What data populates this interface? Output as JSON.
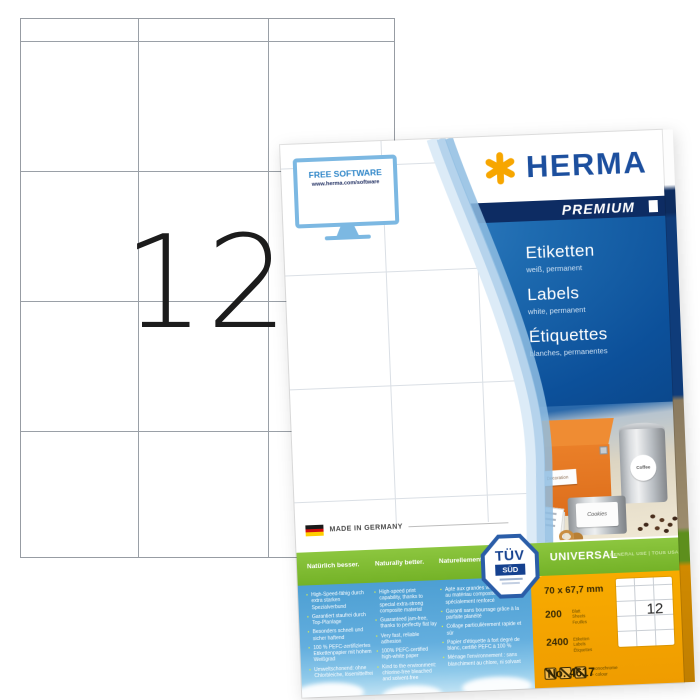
{
  "sheet": {
    "labels_per_sheet": "12"
  },
  "package": {
    "free_software": {
      "title": "FREE SOFTWARE",
      "url": "www.herma.com/software"
    },
    "brand": {
      "name": "HERMA",
      "tier": "PREMIUM",
      "brand_blue": "#1c4f9e",
      "star_yellow": "#f7a600"
    },
    "product": {
      "de": {
        "title": "Etiketten",
        "subtitle": "weiß, permanent"
      },
      "en": {
        "title": "Labels",
        "subtitle": "white, permanent"
      },
      "fr": {
        "title": "Étiquettes",
        "subtitle": "blanches, permanentes"
      }
    },
    "photo_labels": {
      "box": "Decoration",
      "coffee": "Coffee",
      "cookies": "Cookies"
    },
    "made_in": "MADE IN GERMANY",
    "claims": {
      "de": {
        "heading": "Natürlich besser.",
        "bullets": [
          "High-Speed-fähig durch extra starken Spezialverbund",
          "Garantiert staufrei durch Top-Planlage",
          "Besonders schnell und sicher haftend",
          "100 % PEFC-zertifiziertes Etikettenpapier mit hohem Weißgrad",
          "Umweltschonend: ohne Chlorbleiche, lösemittelfrei"
        ]
      },
      "en": {
        "heading": "Naturally better.",
        "bullets": [
          "High-speed print capability, thanks to special extra-strong composite material",
          "Guaranteed jam-free, thanks to perfectly flat lay",
          "Very fast, reliable adhesion",
          "100% PEFC-certified high-white paper",
          "Kind to the environment: chlorine-free bleached and solvent-free"
        ]
      },
      "fr": {
        "heading": "Naturellement mieux.",
        "bullets": [
          "Apte aux grandes vitesses grâce au matériau composite spécialement renforcé",
          "Garanti sans bourrage grâce à la parfaite planéité",
          "Collage particulièrement rapide et sûr",
          "Papier d'étiquette à fort degré de blanc, certifié PEFC à 100 %",
          "Ménage l'environnement : sans blanchiment au chlore, ni solvant"
        ]
      }
    },
    "tuv": {
      "line1": "TÜV",
      "line2": "SÜD"
    },
    "universal": {
      "title": "UNIVERSAL",
      "subtitle": "GENERAL USE | TOUS USAGES",
      "green": "#76b82a"
    },
    "specs": {
      "size": "70 x 67,7 mm",
      "sheets": {
        "value": "200",
        "units": [
          "Blatt",
          "Sheets",
          "Feuilles"
        ]
      },
      "labels": {
        "value": "2400",
        "units": [
          "Etiketten",
          "Labels",
          "Étiquettes"
        ]
      },
      "print_line1": "monochrome",
      "print_line2": "+ colour",
      "item_no": "No. 4617",
      "labels_per_sheet": "12",
      "orange": "#f5a201"
    }
  }
}
